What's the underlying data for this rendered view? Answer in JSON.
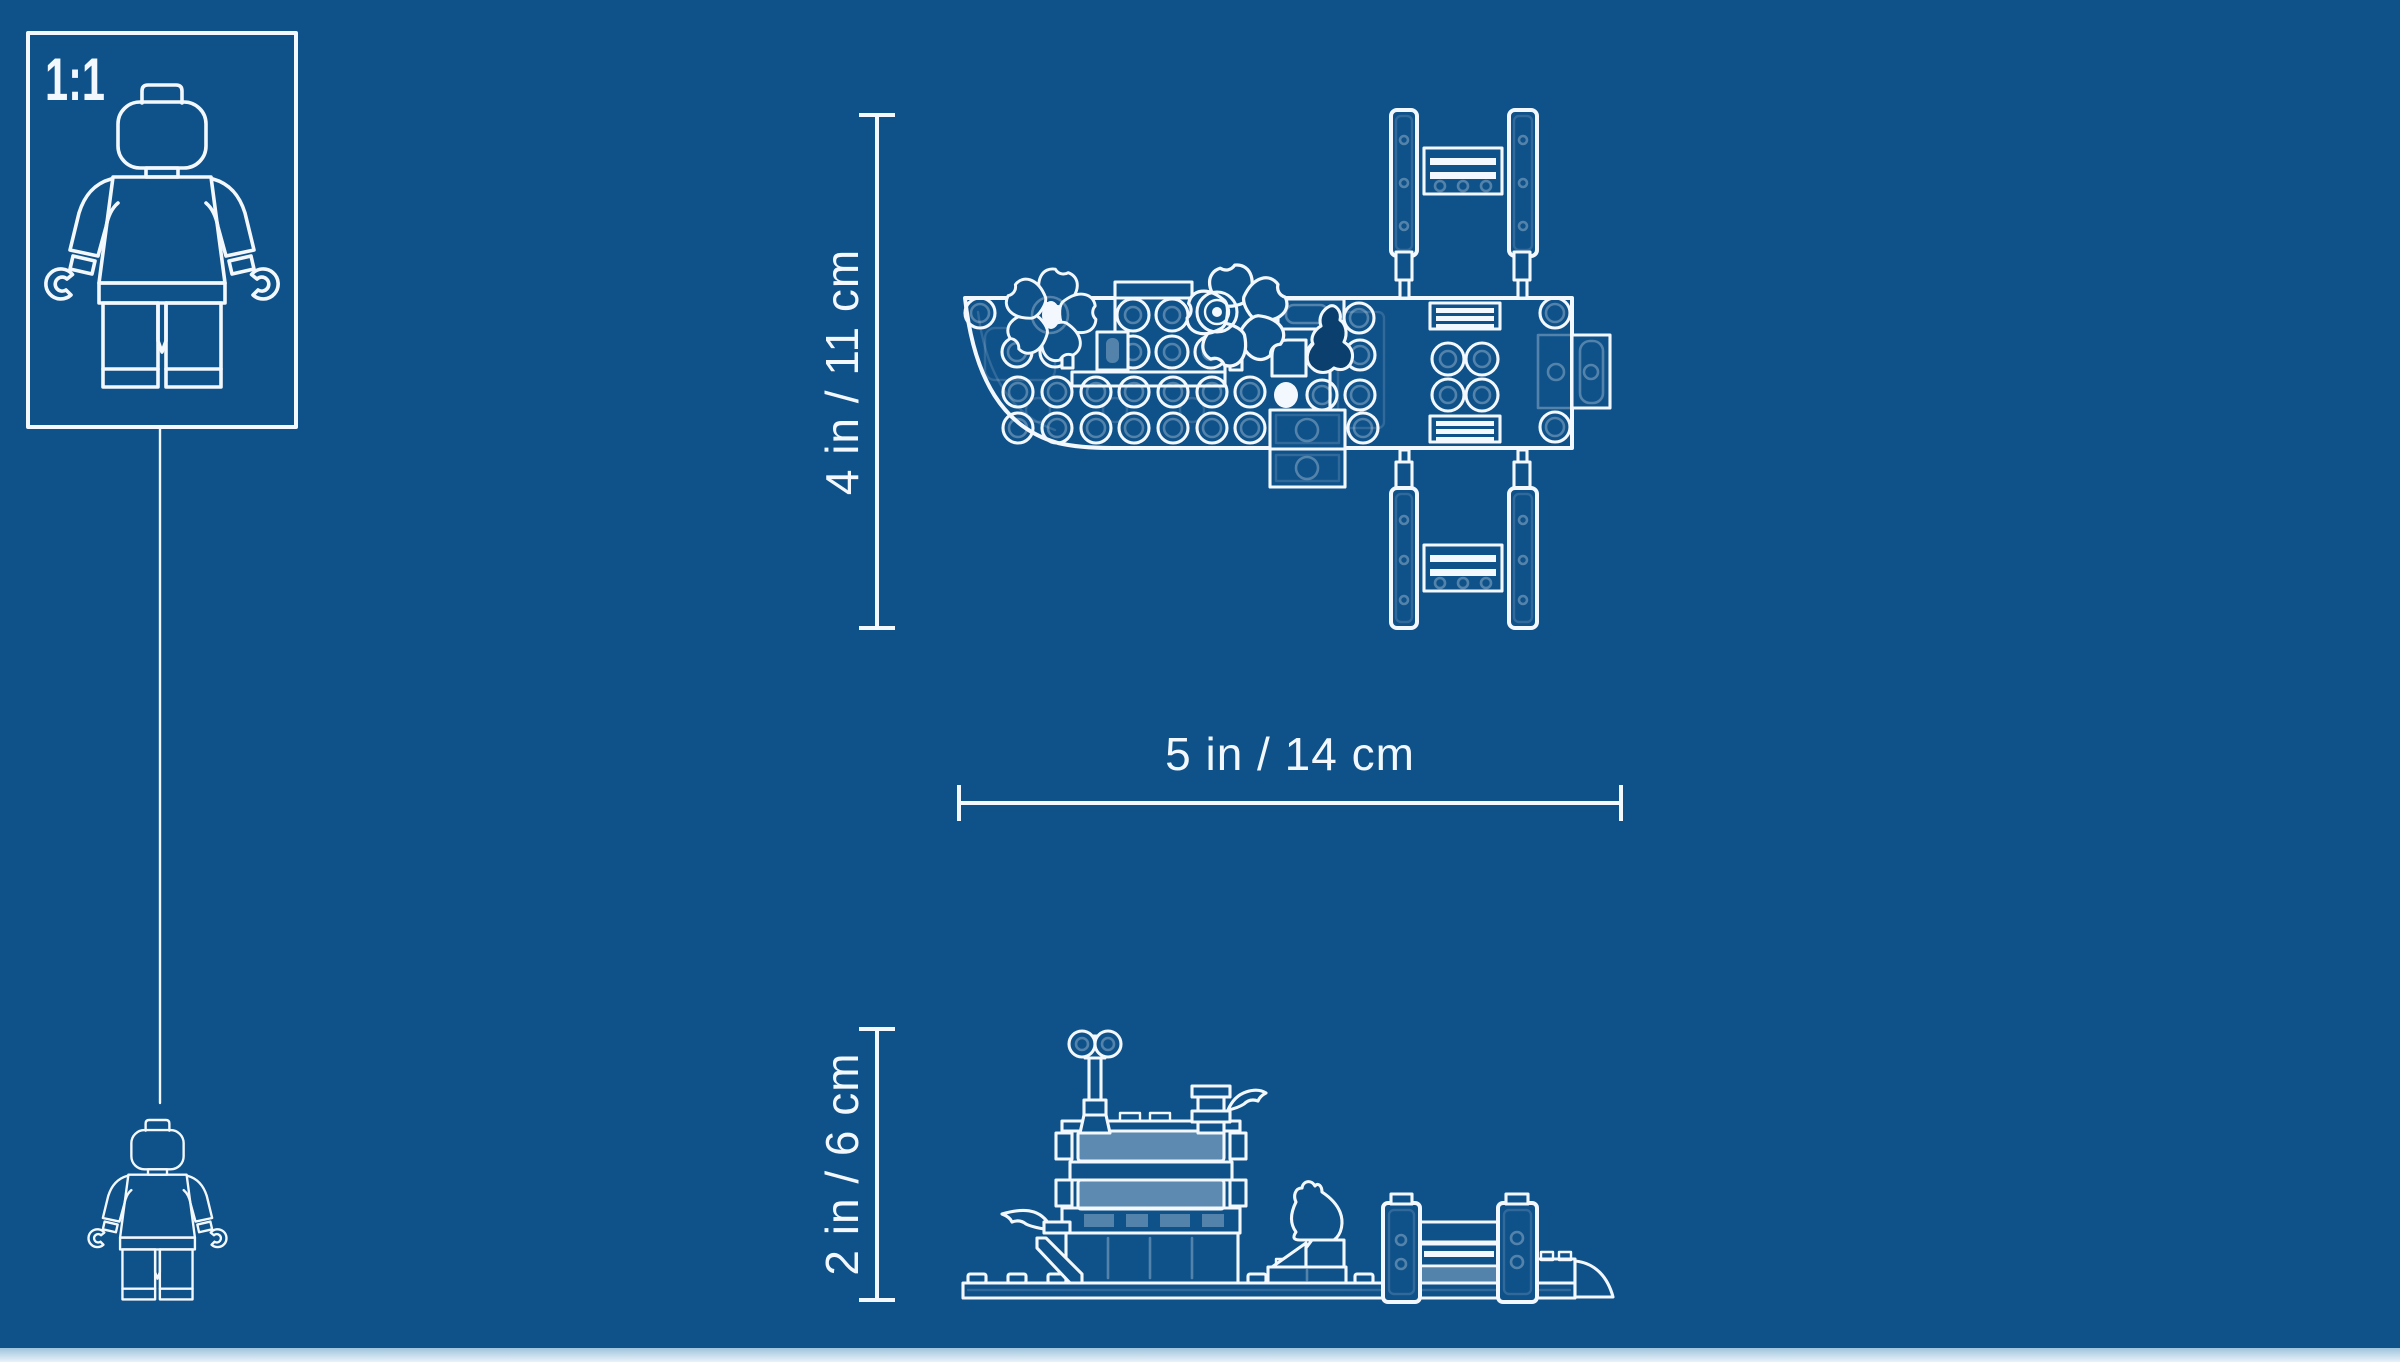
{
  "colors": {
    "background": "#0F5189",
    "line": "#F2F8FD",
    "line_faint": "rgba(242,248,253,0.30)",
    "line_ghost": "rgba(242,248,253,0.15)",
    "panel_fill": "rgba(242,248,253,0.34)",
    "seal_fill": "#0A3F6E",
    "footer_strip": "#BBD6EA"
  },
  "scale_reference": {
    "ratio_label": "1:1"
  },
  "dimensions": {
    "top_view_height": "4 in / 11 cm",
    "top_view_length": "5 in / 14 cm",
    "side_view_height": "2 in / 6 cm"
  }
}
